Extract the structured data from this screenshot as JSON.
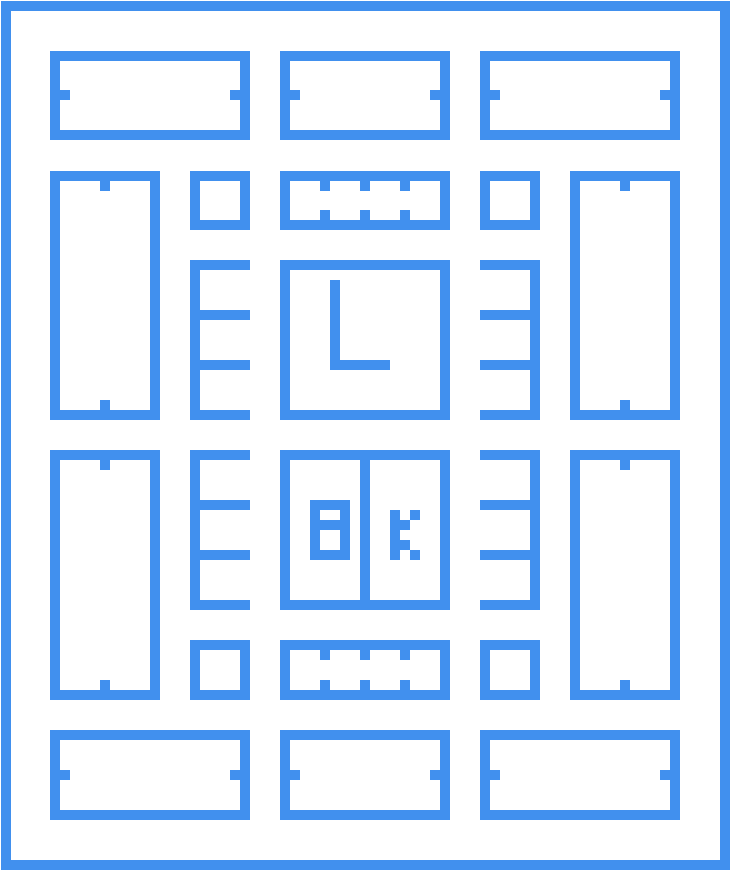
{
  "meta": {
    "kind": "blueprint-floor-plan",
    "sign_text": "8K",
    "clock_glyph": "L"
  },
  "palette": {
    "ink": "#4190ee",
    "background": "#ffffff"
  },
  "canvas": {
    "width": 731,
    "height": 871,
    "wall_thickness": 10
  },
  "objects": [
    {
      "name": "outer-wall",
      "kind": "frame",
      "x": 1,
      "y": 1,
      "w": 729,
      "h": 869,
      "notches": []
    },
    {
      "name": "room-top-left",
      "kind": "frame",
      "x": 50,
      "y": 51,
      "w": 200,
      "h": 89,
      "notches": [
        {
          "edge": "left",
          "at": 90
        },
        {
          "edge": "right",
          "at": 90
        }
      ]
    },
    {
      "name": "room-top-center",
      "kind": "frame",
      "x": 280,
      "y": 51,
      "w": 170,
      "h": 89,
      "notches": [
        {
          "edge": "left",
          "at": 90
        },
        {
          "edge": "right",
          "at": 90
        }
      ]
    },
    {
      "name": "room-top-right",
      "kind": "frame",
      "x": 480,
      "y": 51,
      "w": 200,
      "h": 89,
      "notches": [
        {
          "edge": "left",
          "at": 90
        },
        {
          "edge": "right",
          "at": 90
        }
      ]
    },
    {
      "name": "hall-left-upper",
      "kind": "frame",
      "x": 50,
      "y": 171,
      "w": 110,
      "h": 249,
      "notches": [
        {
          "edge": "top",
          "at": 100
        },
        {
          "edge": "bottom",
          "at": 100
        }
      ]
    },
    {
      "name": "cabinet-upper-left",
      "kind": "frame",
      "x": 190,
      "y": 171,
      "w": 60,
      "h": 59,
      "notches": []
    },
    {
      "name": "vent-top",
      "kind": "frame",
      "x": 280,
      "y": 171,
      "w": 170,
      "h": 59,
      "notches": [
        {
          "edge": "top",
          "at": 320
        },
        {
          "edge": "top",
          "at": 360
        },
        {
          "edge": "top",
          "at": 400
        },
        {
          "edge": "bottom",
          "at": 320
        },
        {
          "edge": "bottom",
          "at": 360
        },
        {
          "edge": "bottom",
          "at": 400
        }
      ]
    },
    {
      "name": "cabinet-upper-right",
      "kind": "frame",
      "x": 480,
      "y": 171,
      "w": 60,
      "h": 59,
      "notches": []
    },
    {
      "name": "hall-right-upper",
      "kind": "frame",
      "x": 570,
      "y": 171,
      "w": 110,
      "h": 249,
      "notches": [
        {
          "edge": "top",
          "at": 620
        },
        {
          "edge": "bottom",
          "at": 620
        }
      ]
    },
    {
      "name": "rack-left-upper",
      "kind": "rects",
      "rects": [
        [
          190,
          260,
          10,
          160
        ],
        [
          190,
          260,
          60,
          10
        ],
        [
          190,
          310,
          60,
          10
        ],
        [
          190,
          360,
          60,
          10
        ],
        [
          190,
          410,
          60,
          10
        ]
      ]
    },
    {
      "name": "clock-room",
      "kind": "frame",
      "x": 280,
      "y": 260,
      "w": 170,
      "h": 160,
      "notches": []
    },
    {
      "name": "clock-hands",
      "kind": "rects",
      "label": "L",
      "rects": [
        [
          330,
          280,
          10,
          90
        ],
        [
          330,
          360,
          60,
          10
        ]
      ]
    },
    {
      "name": "rack-right-upper",
      "kind": "rects",
      "rects": [
        [
          530,
          260,
          10,
          160
        ],
        [
          480,
          260,
          60,
          10
        ],
        [
          480,
          310,
          60,
          10
        ],
        [
          480,
          360,
          60,
          10
        ],
        [
          480,
          410,
          60,
          10
        ]
      ]
    },
    {
      "name": "hall-left-lower",
      "kind": "frame",
      "x": 50,
      "y": 450,
      "w": 110,
      "h": 250,
      "notches": [
        {
          "edge": "top",
          "at": 100
        },
        {
          "edge": "bottom",
          "at": 100
        }
      ]
    },
    {
      "name": "rack-left-lower",
      "kind": "rects",
      "rects": [
        [
          190,
          450,
          10,
          160
        ],
        [
          190,
          450,
          60,
          10
        ],
        [
          190,
          500,
          60,
          10
        ],
        [
          190,
          550,
          60,
          10
        ],
        [
          190,
          600,
          60,
          10
        ]
      ]
    },
    {
      "name": "sign-room",
      "kind": "frame",
      "x": 280,
      "y": 450,
      "w": 170,
      "h": 160,
      "label": "8K",
      "notches": []
    },
    {
      "name": "sign-room-divider",
      "kind": "rects",
      "rects": [
        [
          360,
          450,
          10,
          160
        ]
      ]
    },
    {
      "name": "glyph-8",
      "kind": "rects",
      "label": "8",
      "rects": [
        [
          310,
          500,
          40,
          10
        ],
        [
          310,
          520,
          40,
          10
        ],
        [
          310,
          550,
          40,
          10
        ],
        [
          310,
          510,
          10,
          10
        ],
        [
          340,
          510,
          10,
          10
        ],
        [
          310,
          530,
          10,
          20
        ],
        [
          340,
          530,
          10,
          20
        ]
      ]
    },
    {
      "name": "glyph-k",
      "kind": "rects",
      "label": "K",
      "rects": [
        [
          390,
          510,
          10,
          50
        ],
        [
          410,
          510,
          10,
          10
        ],
        [
          400,
          520,
          10,
          10
        ],
        [
          400,
          540,
          10,
          10
        ],
        [
          410,
          550,
          10,
          10
        ]
      ]
    },
    {
      "name": "rack-right-lower",
      "kind": "rects",
      "rects": [
        [
          530,
          450,
          10,
          160
        ],
        [
          480,
          450,
          60,
          10
        ],
        [
          480,
          500,
          60,
          10
        ],
        [
          480,
          550,
          60,
          10
        ],
        [
          480,
          600,
          60,
          10
        ]
      ]
    },
    {
      "name": "hall-right-lower",
      "kind": "frame",
      "x": 570,
      "y": 450,
      "w": 110,
      "h": 250,
      "notches": [
        {
          "edge": "top",
          "at": 620
        },
        {
          "edge": "bottom",
          "at": 620
        }
      ]
    },
    {
      "name": "cabinet-lower-left",
      "kind": "frame",
      "x": 190,
      "y": 640,
      "w": 60,
      "h": 60,
      "notches": []
    },
    {
      "name": "vent-bottom",
      "kind": "frame",
      "x": 280,
      "y": 640,
      "w": 170,
      "h": 60,
      "notches": [
        {
          "edge": "top",
          "at": 320
        },
        {
          "edge": "top",
          "at": 360
        },
        {
          "edge": "top",
          "at": 400
        },
        {
          "edge": "bottom",
          "at": 320
        },
        {
          "edge": "bottom",
          "at": 360
        },
        {
          "edge": "bottom",
          "at": 400
        }
      ]
    },
    {
      "name": "cabinet-lower-right",
      "kind": "frame",
      "x": 480,
      "y": 640,
      "w": 60,
      "h": 60,
      "notches": []
    },
    {
      "name": "room-bottom-left",
      "kind": "frame",
      "x": 50,
      "y": 730,
      "w": 200,
      "h": 90,
      "notches": [
        {
          "edge": "left",
          "at": 770
        },
        {
          "edge": "right",
          "at": 770
        }
      ]
    },
    {
      "name": "room-bottom-center",
      "kind": "frame",
      "x": 280,
      "y": 730,
      "w": 170,
      "h": 90,
      "notches": [
        {
          "edge": "left",
          "at": 770
        },
        {
          "edge": "right",
          "at": 770
        }
      ]
    },
    {
      "name": "room-bottom-right",
      "kind": "frame",
      "x": 480,
      "y": 730,
      "w": 200,
      "h": 90,
      "notches": [
        {
          "edge": "left",
          "at": 770
        },
        {
          "edge": "right",
          "at": 770
        }
      ]
    }
  ]
}
